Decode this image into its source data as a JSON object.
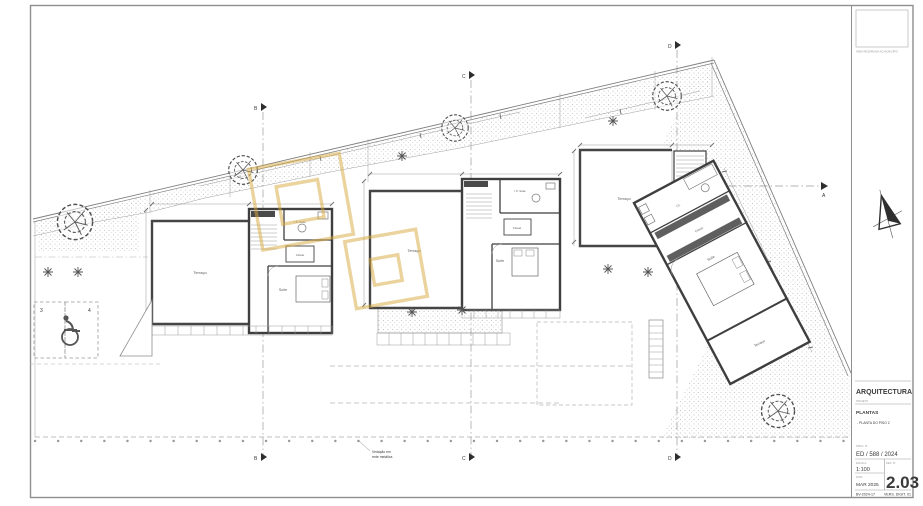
{
  "colors": {
    "gold_watermark": "#D9A93E",
    "wall": "#3e3e3e",
    "thin_line": "#9a9a9a"
  },
  "stamp": {
    "caption": "ÁREA RESERVADA AO MUNICÍPIO"
  },
  "titleblock": {
    "discipline": "ARQUITECTURA",
    "type_caption": "PROJETO",
    "type": "PLANTAS",
    "subtitle": "- PLANTA DO PISO 2",
    "process_caption": "PROC. Nº",
    "process": "ED / 588 / 2024",
    "scale_caption": "ESCALA",
    "scale": "1:100",
    "date_caption": "DATA",
    "date": "MAR 2025",
    "number_caption": "DES. Nº",
    "number": "2.03",
    "ref": "BV-2024-17",
    "version": "VERS. DIGIT. 01"
  },
  "rooms": {
    "terrace": "Terraço",
    "suite": "Suite",
    "closet": "Closet",
    "is_suite": "I.S. Suite",
    "is": "I.S."
  },
  "sections": {
    "a": "A",
    "b": "B",
    "c": "C",
    "d": "D"
  },
  "parking": {
    "stall_3": "3",
    "stall_4": "4"
  },
  "notes": {
    "fence_1": "Vedação em",
    "fence_2": "rede metálica"
  }
}
